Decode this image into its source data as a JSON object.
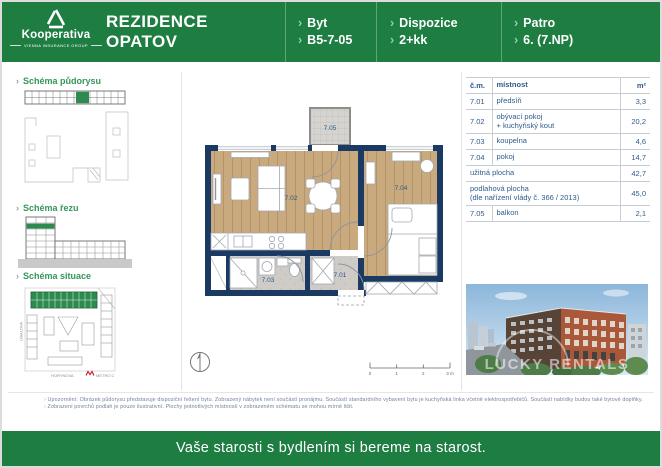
{
  "header": {
    "logo": {
      "brand": "Kooperativa",
      "group": "VIENNA INSURANCE GROUP"
    },
    "title_line1": "REZIDENCE",
    "title_line2": "OPATOV",
    "fields": [
      {
        "label": "Byt",
        "value": "B5-7-05"
      },
      {
        "label": "Dispozice",
        "value": "2+kk"
      },
      {
        "label": "Patro",
        "value": "6. (7.NP)"
      }
    ]
  },
  "sidebar": {
    "sections": [
      {
        "label": "Schéma půdorysu"
      },
      {
        "label": "Schéma řezu"
      },
      {
        "label": "Schéma situace"
      }
    ],
    "site_map": {
      "street_left": "LÍBALOVA",
      "street_bottom": "HORYNOVA",
      "metro": "METRO C"
    }
  },
  "floorplan": {
    "labels": {
      "hall": "7.01",
      "living": "7.02",
      "bathroom": "7.03",
      "bedroom": "7.04",
      "balcony": "7.05"
    },
    "scale_ticks": [
      "0",
      "1",
      "2",
      "3 m"
    ]
  },
  "table": {
    "headers": {
      "num": "č.m.",
      "room": "místnost",
      "area": "m²"
    },
    "rows": [
      {
        "num": "7.01",
        "room": "předsíň",
        "area": "3,3"
      },
      {
        "num": "7.02",
        "room": "obývací pokoj\n+ kuchyňský kout",
        "area": "20,2"
      },
      {
        "num": "7.03",
        "room": "koupelna",
        "area": "4,6"
      },
      {
        "num": "7.04",
        "room": "pokoj",
        "area": "14,7"
      }
    ],
    "summary_rows": [
      {
        "room": "užitná plocha",
        "area": "42,7"
      },
      {
        "room": "podlahová plocha\n(dle nařízení vlády č. 366 / 2013)",
        "area": "45,0"
      }
    ],
    "balcony_row": {
      "num": "7.05",
      "room": "balkon",
      "area": "2,1"
    }
  },
  "photo": {
    "watermark": "LUCKY RENTALS"
  },
  "notes": [
    "Upozornění: Obrázek půdorysu představuje dispoziční řešení bytu. Zobrazený nábytek není součástí pronájmu. Součástí standardního vybavení bytu je kuchyňská linka včetně elektrospotřebičů. Součástí nabídky budou také bytové doplňky.",
    "Zobrazení povrchů podlah je pouze ilustrativní. Plochy jednotlivých místností v zobrazeném schématu se mohou mírně lišit."
  ],
  "slogan": "Vaše starosti s bydlením si bereme na starost.",
  "colors": {
    "brand_green": "#1e7d41",
    "wall_navy": "#1a3a63",
    "wood": "#c9a97e",
    "tile": "#cfccc8",
    "table_text": "#2f5b8e"
  }
}
